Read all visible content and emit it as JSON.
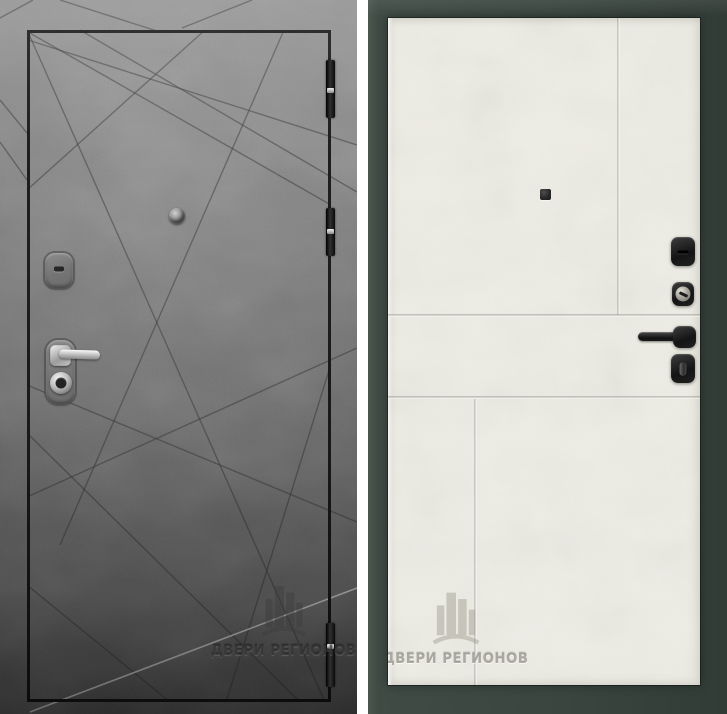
{
  "photo": {
    "subject": "steel-entrance-door-product-photo-front-and-back",
    "watermark_text": "ДВЕРИ РЕГИОНОВ"
  },
  "exterior_panel": {
    "finish_color": "#7a7a7a",
    "groove_color": "#3a3a3a",
    "leaf_outline_color": "#141414",
    "hardware": [
      "peephole",
      "keyhole-escutcheon",
      "lever-handle",
      "key-cylinder",
      "hinge-top",
      "hinge-middle",
      "hinge-bottom"
    ]
  },
  "interior_panel": {
    "leaf_color": "#edece4",
    "frame_color": "#3e4943",
    "hardware": [
      "peephole",
      "lock-escutcheon",
      "key-cylinder-knob",
      "lever-handle",
      "thumbturn"
    ]
  }
}
